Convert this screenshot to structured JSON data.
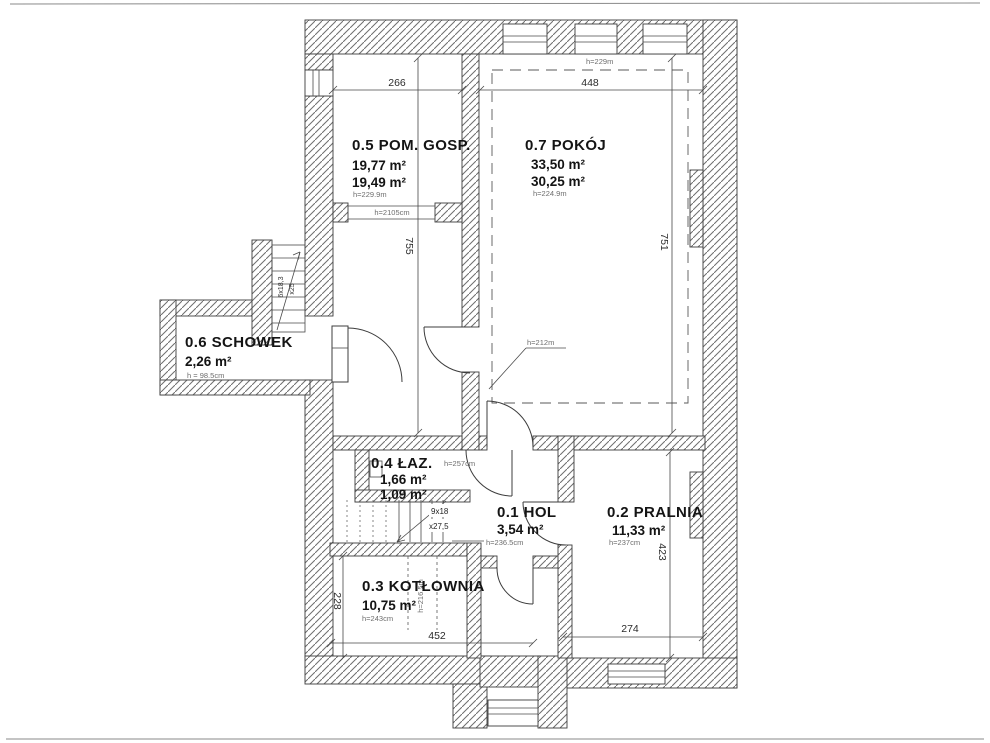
{
  "rooms": {
    "hol": {
      "label": "0.1 HOL",
      "area": "3,54 m²",
      "height": "h=236.5cm"
    },
    "pralnia": {
      "label": "0.2 PRALNIA",
      "area": "11,33 m²",
      "height": "h=237cm"
    },
    "kotlownia": {
      "label": "0.3 KOTŁOWNIA",
      "area": "10,75 m²",
      "height": "h=243cm"
    },
    "laz": {
      "label": "0.4 ŁAZ.",
      "area": "1,66 m²",
      "area2": "1,09 m²",
      "height": "h=257cm"
    },
    "pom_gosp": {
      "label": "0.5 POM. GOSP.",
      "area": "19,77 m²",
      "area2": "19,49 m²",
      "height": "h=229.9m"
    },
    "schowek": {
      "label": "0.6 SCHOWEK",
      "area": "2,26 m²",
      "height": "h = 98.5cm"
    },
    "pokoj": {
      "label": "0.7 POKÓJ",
      "area": "33,50 m²",
      "area2": "30,25 m²",
      "height": "h=224.9m"
    }
  },
  "dimensions": {
    "pom_gosp_width": "266",
    "pokoj_width": "448",
    "pom_gosp_depth": "755",
    "pokoj_depth": "751",
    "pralnia_depth": "423",
    "kotlownia_depth": "228",
    "kotlownia_width": "452",
    "pralnia_width": "274"
  },
  "annotations": {
    "attic_height": "h=229m",
    "passage_height": "h=2105cm",
    "door_height": "h=212m",
    "lobby_door_height": "h=216.5m"
  },
  "stairs": {
    "upper": {
      "line1": "6x18,3",
      "line2": "x25"
    },
    "lower": {
      "line1": "9x18",
      "line2": "x27,5"
    }
  },
  "colors": {
    "wall_hatch": "#6e6e6e",
    "line": "#3c3c3c",
    "dim_line": "#474747",
    "muted_text": "#6d6d6d"
  }
}
